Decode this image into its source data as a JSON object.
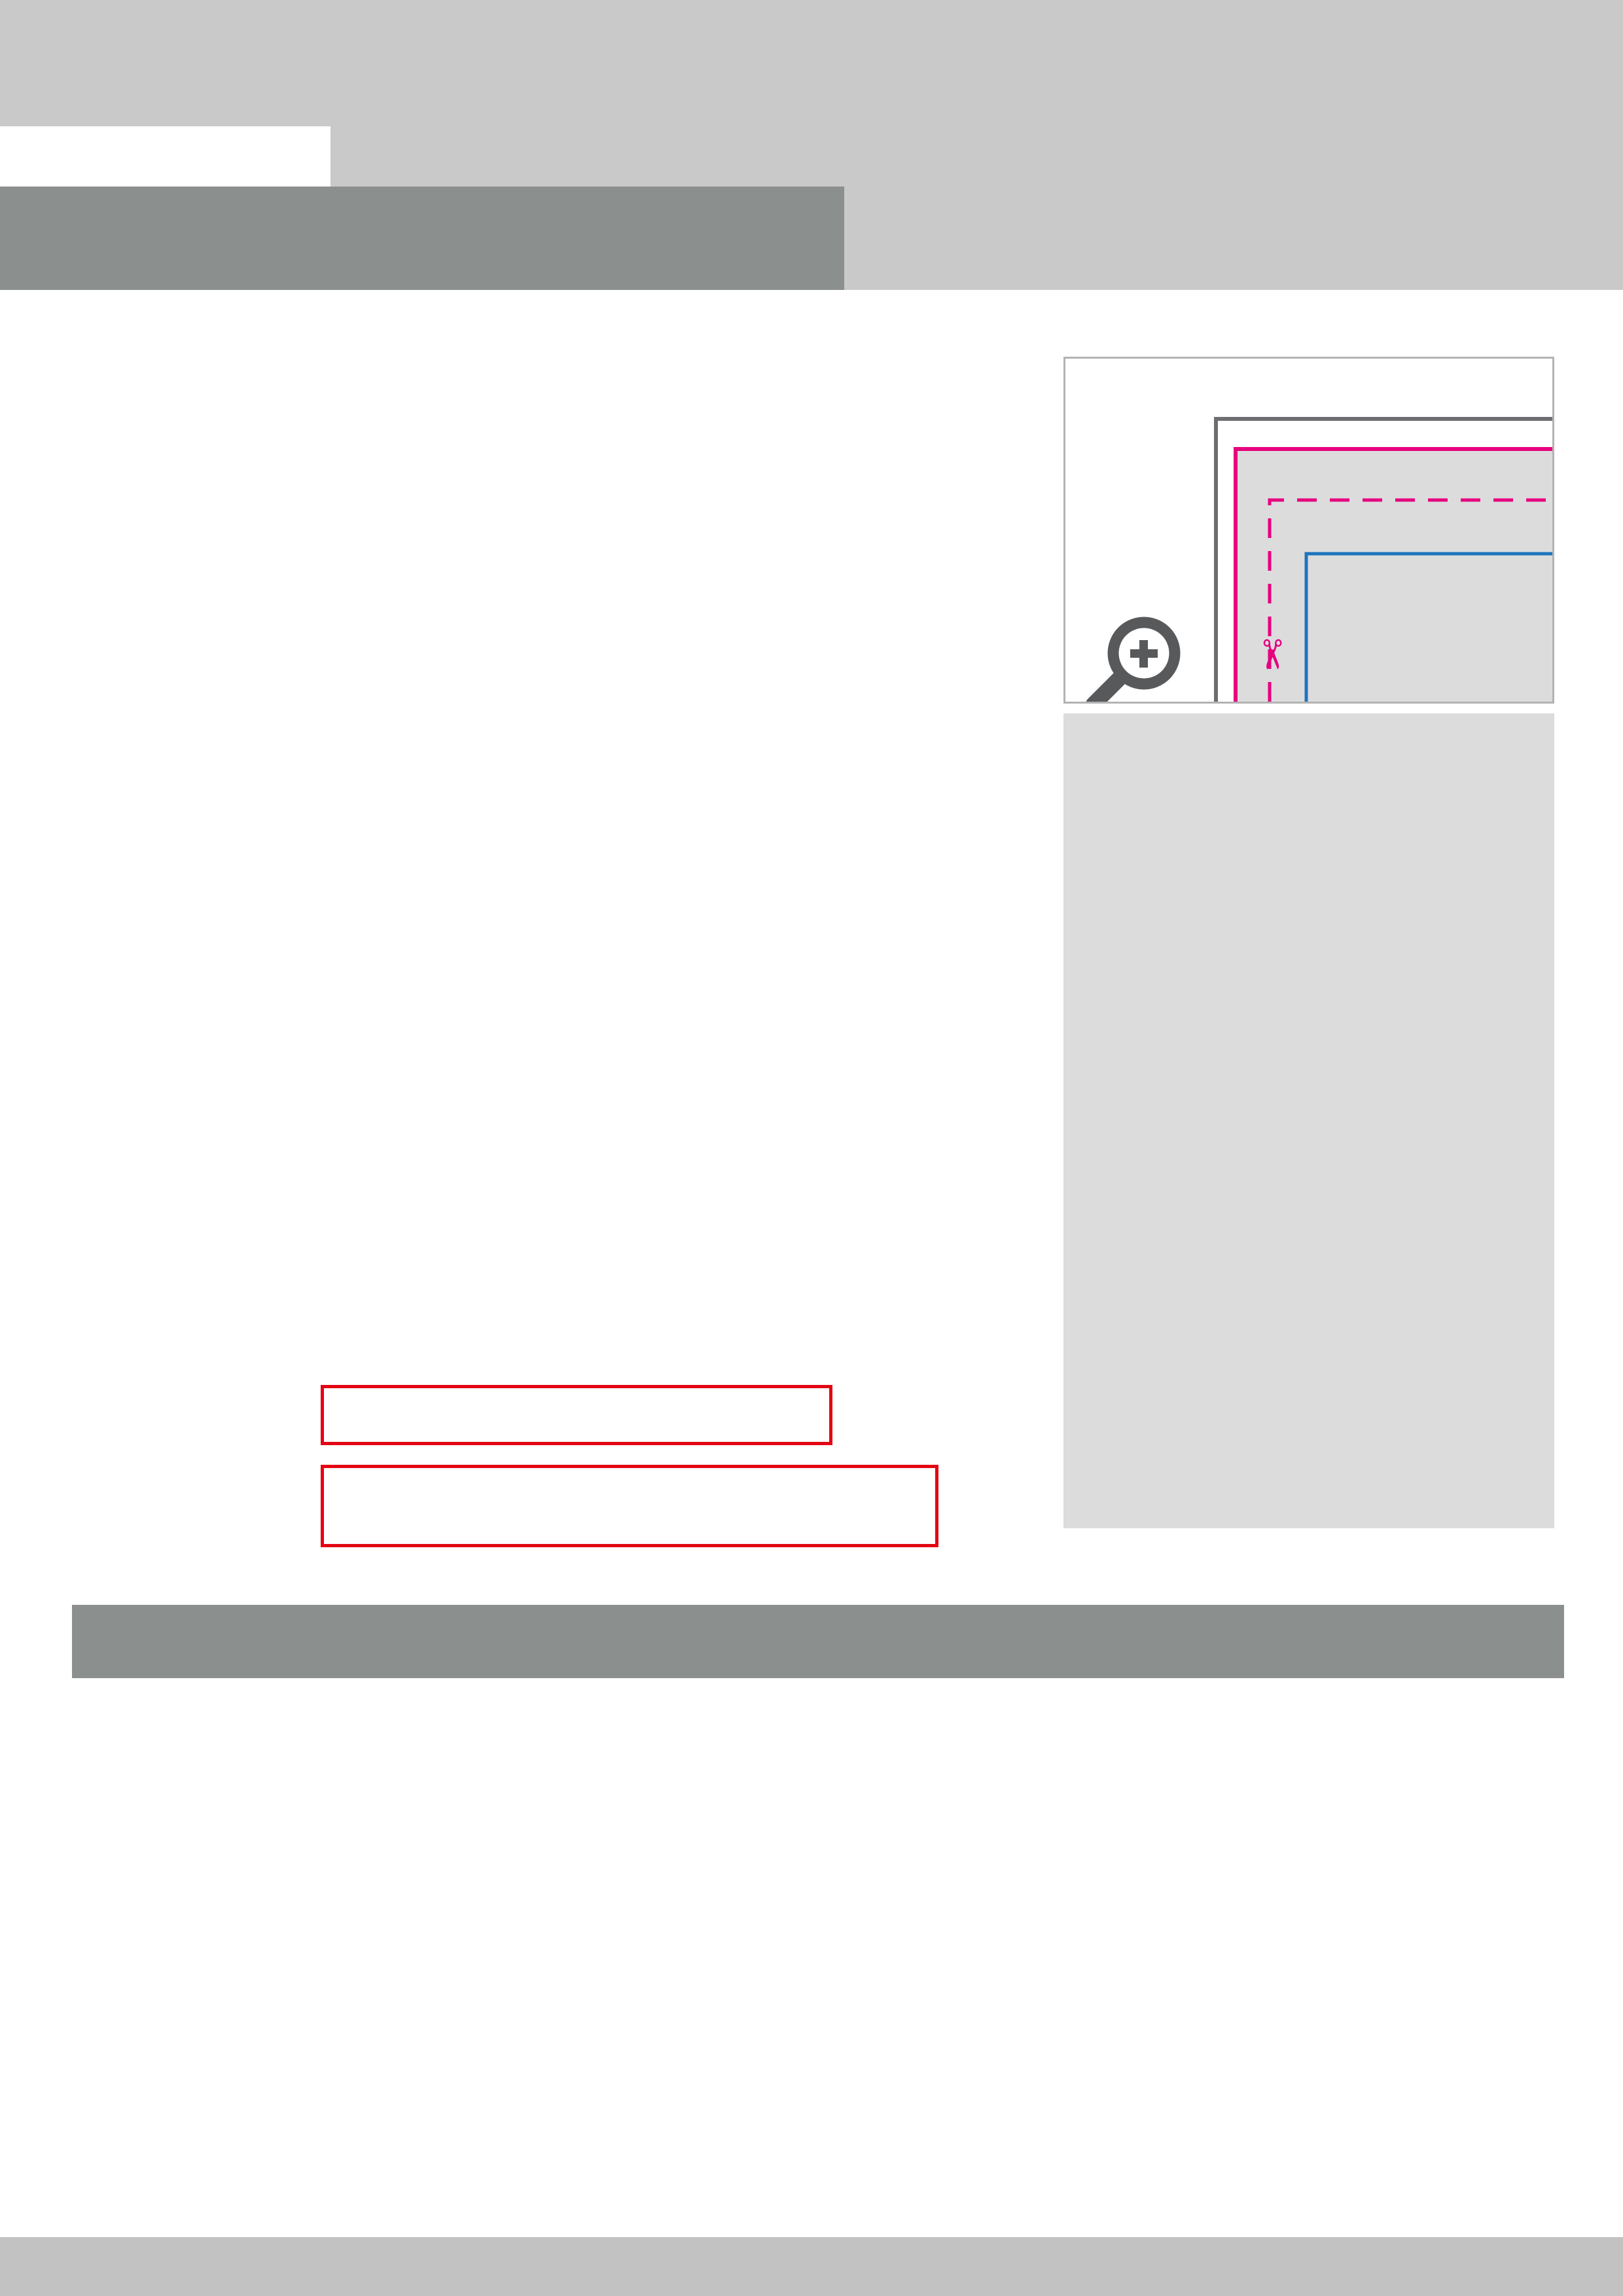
{
  "header": {
    "sheet_label": "Datenblatt",
    "product_title": "Schleifenverpackung",
    "product_subtitle": "mit Fenster, 100 x 70 x 65 mm, beidseitig"
  },
  "colors": {
    "page_gray": "#c9c9c9",
    "banner_gray": "#8b8f8e",
    "magenta": "#e6007e",
    "blue": "#1c75bc",
    "cyan": "#29abe2",
    "flap_cyan": "#57c4ec",
    "salmon": "#edcab8",
    "panel_gray": "#dcdcdd",
    "line_gray": "#6d6e71",
    "red": "#e30613"
  },
  "dielines": [
    {
      "width_label": "363 mm",
      "trim_width_label": "353 mm",
      "segments": [
        "70 mm",
        "100 mm",
        "70 mm",
        "100 mm",
        "13 mm"
      ],
      "height_label": "216 mm",
      "trim_height_label": "206 mm",
      "v_segments": [
        "76 mm",
        "65 mm",
        "65 mm"
      ],
      "window": {
        "width_label": "50 mm",
        "height_label": "30 mm"
      },
      "griff_labels": [
        "GRIFF SEITE C",
        "GRIFF SEITE D"
      ],
      "deckel_labels": [
        "DECKEL SEITE C",
        "DECKEL SEITE A",
        "DECKEL SEITE D",
        "DECKEL SEITE B"
      ],
      "seite_labels": [
        "SEITE C",
        "SEITE A",
        "SEITE D",
        "SEITE B"
      ],
      "boden_labels": [
        "BODEN SEITE C",
        "BODEN SEITE A",
        "BODEN SEITE D",
        "BODEN SEITE B"
      ]
    },
    {
      "width_label": "363 mm",
      "trim_width_label": "353 mm",
      "segments": [
        "13 mm",
        "100 mm",
        "70 mm",
        "100 mm",
        "70 mm"
      ],
      "height_label": "216 mm",
      "trim_height_label": "206 mm",
      "v_segments": [
        "76 mm",
        "65 mm",
        "65 mm"
      ],
      "window": {
        "width_label": "50 mm",
        "height_label": "30 mm"
      },
      "griff_labels": [
        "GRIFF SEITE D",
        "GRIFF SEITE C"
      ],
      "deckel_labels": [
        "DECKEL SEITE B",
        "DECKEL SEITE D",
        "DECKEL SEITE A",
        "DECKEL SEITE C"
      ],
      "seite_labels": [
        "SEITE B",
        "SEITE D",
        "SEITE A",
        "SEITE C"
      ],
      "boden_labels": [
        "BODEN SEITE B",
        "BODEN SEITE D",
        "BODEN SEITE A",
        "BODEN SEITE C"
      ]
    }
  ],
  "info_panel": {
    "datenformat": {
      "title": "Datenformat: 363 x 216  mm",
      "body": [
        {
          "t": "Das Format, in dem Ihre Druckdaten angelegt sein sollten. In diesem Format enthalten sind: "
        },
        {
          "t": "5 mm Beschnitt.",
          "b": true
        }
      ]
    },
    "bleed_note": "Bitte legen Sie randabfallende Objekte bis zum Rand des Beschnitts an, um weiße Seitenränder zu vermeiden. Die Beschnittzugabe wird während der Produktion von uns entfernt.",
    "endformat": {
      "title": "Endformat: 353 x 206 mm",
      "body": "Auf dieses Format werden Ihre Druckdaten zugeschnitten."
    },
    "sicherheitsabstand": {
      "title": "Sicherheitsabstand: 3 mm",
      "subtitle": "(auf allen Seiten)",
      "body": "Dieser wird vom Endformat aus gemessen und verhindert unerwünschten Anschnitt Ihrer Texte und Informationen während der Produktion."
    },
    "falzlinien": {
      "title": "Falzlinien",
      "body": "Hier befinden sich die Falzpositionen in Ihrem Produkt"
    }
  },
  "notes": [
    "Bitte achten Sie darauf, dass die blau markierten Klebeflächen und rot markierten Bereiche im gefalteten Zustand nicht zu sehen sind.",
    "Aufgrund der Komplexität empfehlen wir Ihnen die \"Druckvorlage (zur freien Verwendung)\" als Schablone zu nutzen. Bevor Sie uns Ihre Datei zusenden, muss diese Schablone jedoch wieder entfernt werden."
  ],
  "tips": {
    "title": "5 Tipps zur fehlerfreien Gestaltung Ihrer Druckdaten",
    "rows": [
      {
        "label": "Allgemein",
        "body": [
          {
            "t": "Hintergrundbilder, Farben, Verläufe und Grafiken sollten unbedingt bis an den Rand des Datenformats angelegt werden, da produktionstechnisch kleinere Toleranzen beim Schneiden Ihres Druckproduktes auftreten können."
          }
        ]
      },
      {
        "label": "Farbmodus",
        "body": [
          {
            "t": "Der Farbmodus Ihrer Druckdaten muss "
          },
          {
            "t": "CMYK",
            "b": true
          },
          {
            "t": " sein, da sonst nach dem Druckvorgang ein (leicht) veränderter, optischer Gesamteindruck entstehen kann. (Daten im RGB-Farbmodus werden automatisch durch uns nach "
          },
          {
            "t": "CMYK",
            "b": true
          },
          {
            "t": " konvertiert.)"
          }
        ]
      },
      {
        "label": "Auflösung",
        "body": [
          {
            "t": "Die Auflösung von Bildgrafiken sollte mindestens "
          },
          {
            "t": "300 dpi",
            "b": true
          },
          {
            "t": " betragen. Achten Sie darauf, dass Sie für Ihre Druckvorlagen immer hochauflösende Bilder verwenden, da Ihr Druckprodukt andernfalls (leicht) pixelig wirken kann."
          }
        ]
      },
      {
        "label": "Dateiformat",
        "body": [
          {
            "t": "Speichern Sie Ihr Dokument im PDF-Format ab. Achten Sie darauf, Schriften einzubetten und (soweit als möglich) Transparenzen zu reduzieren."
          }
        ]
      },
      {
        "label": "Seiten(-reihenfolge)",
        "body": [
          {
            "t": "Senden Sie mehrseitige Dokumente chronologisch in korrekter Reihenfolge als eine einzige PDF-Datei oder benennen Sie Einzeldokumente entsprechend mit fortlaufenden Seitennummern."
          }
        ]
      }
    ]
  }
}
